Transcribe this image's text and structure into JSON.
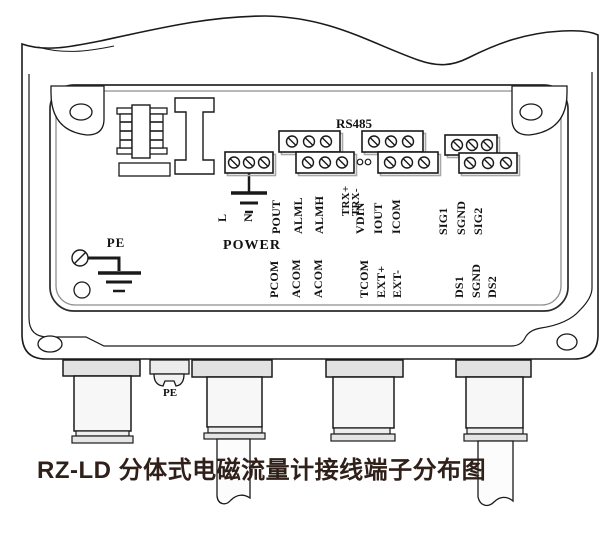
{
  "title": "RZ-LD 分体式电磁流量计接线端子分布图",
  "colors": {
    "line": "#1a1a1a",
    "panel_inner_line": "#8e8e8e",
    "block_shadow": "#a8a8a8",
    "title_text": "#30201a",
    "gland_nut_fill": "#e2e2e2",
    "gland_body_fill": "#f7f7f7"
  },
  "power_group": {
    "caption": "POWER",
    "pin_l": "L",
    "pin_n": "N"
  },
  "rs485": {
    "caption": "RS485",
    "trx_plus": "TRX+",
    "trx_minus": "TRX-"
  },
  "pe": {
    "panel_label": "PE",
    "stud_label": "PE"
  },
  "groups": {
    "g1": {
      "upper": [
        "POUT",
        "ALML",
        "ALMH"
      ],
      "lower": [
        "PCOM",
        "ACOM",
        "ACOM"
      ]
    },
    "g2": {
      "upper": [
        "VDIN",
        "IOUT",
        "ICOM"
      ],
      "lower": [
        "TCOM",
        "EXT+",
        "EXT-"
      ]
    },
    "g3": {
      "upper": [
        "SIG1",
        "SGND",
        "SIG2"
      ],
      "lower": [
        "DS1",
        "SGND",
        "DS2"
      ]
    }
  }
}
